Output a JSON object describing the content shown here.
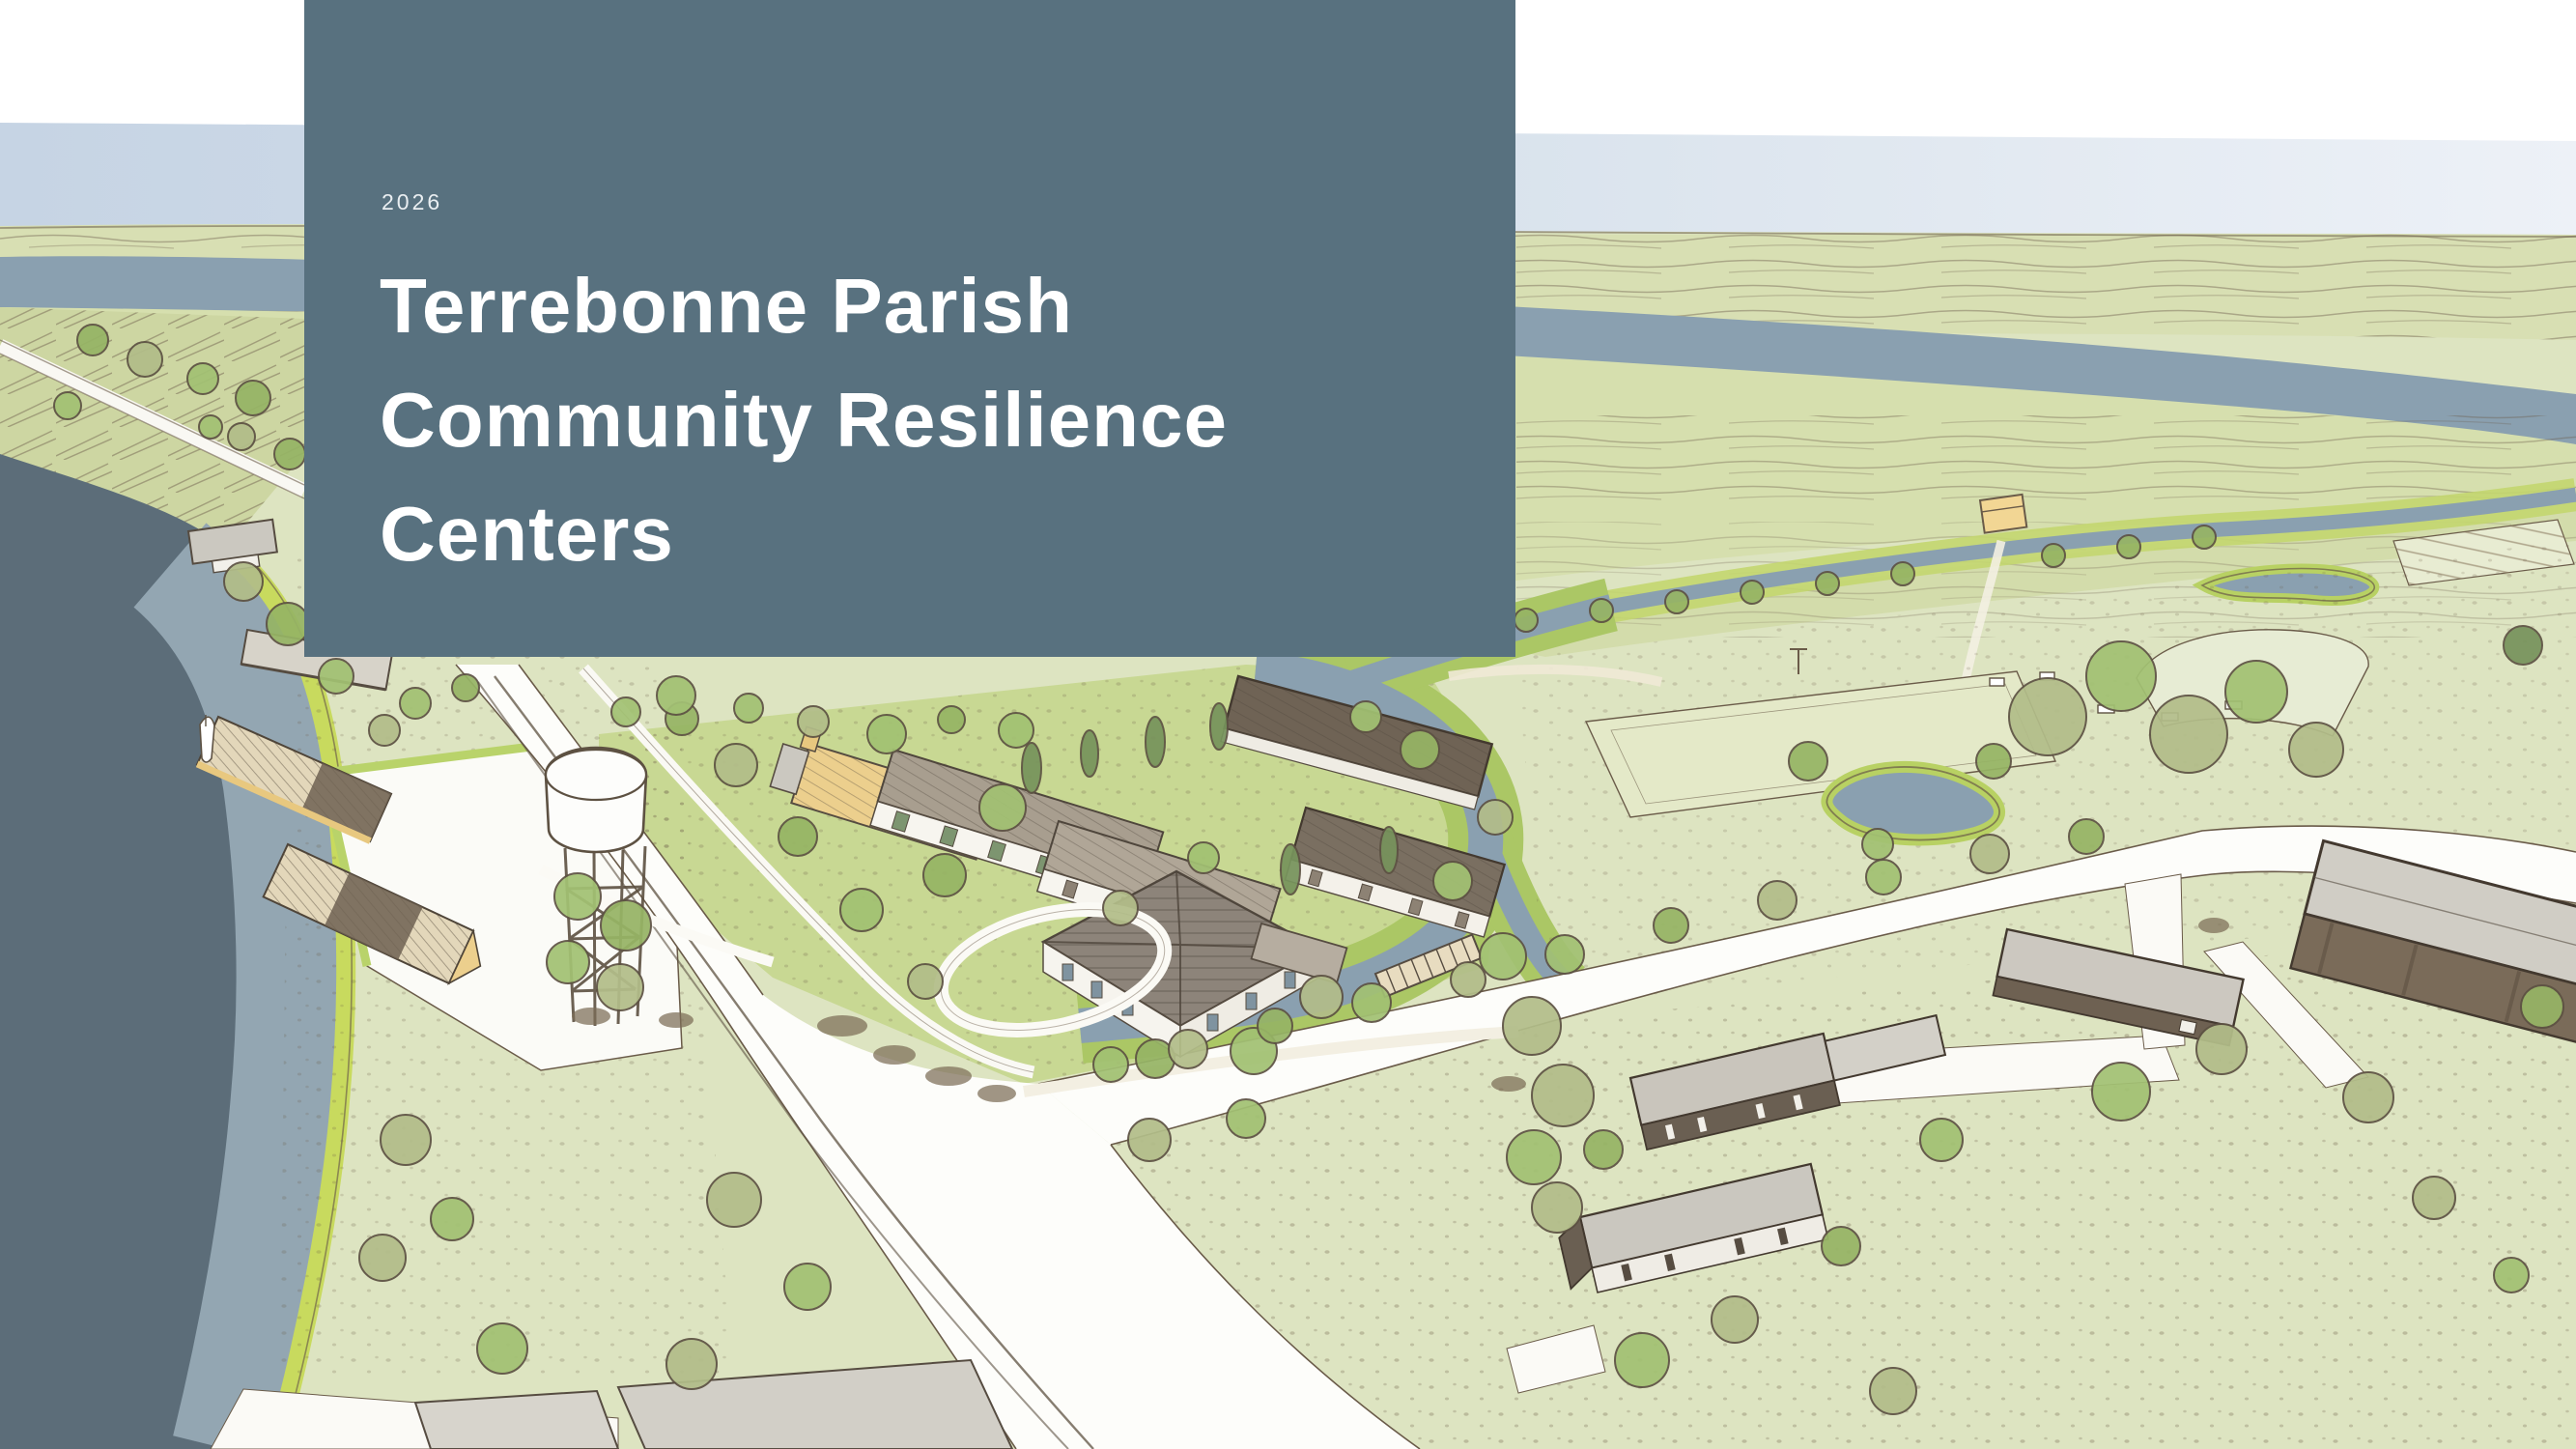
{
  "cover": {
    "year": "2026",
    "title_lines": [
      "Terrebonne Parish",
      "Community Resilience",
      "Centers"
    ],
    "panel_color": "#58717f",
    "title_color": "#ffffff",
    "year_color": "#e9eef1"
  },
  "illustration": {
    "scene": "Hand-drawn aerial sketch of a bayou-side community: white sky band, pale blue sky, marsh horizon, wide slate river, bay shoreline with pier buildings and sailboat, white water tower on trestle legs, campus of resilience-center buildings wrapped by a lagoon, diagonal main road with branch road, sports fields, ponds, farm houses and a large warehouse",
    "palette": {
      "sky": "#c6d4e4",
      "sky_right": "#edf1f7",
      "marsh": "#d8dfb3",
      "river": "#8aa0b0",
      "bay_deep": "#5c6d79",
      "bay_shallow": "#93a6b2",
      "shoreline": "#c8da5e",
      "land": "#dde4c1",
      "lawn_bright": "#c8d893",
      "road": "#fdfdfa",
      "ink": "#5d5142",
      "roof_gray": "#b0a697",
      "roof_dark": "#6f6355",
      "roof_yellow": "#eccf8d",
      "tree_olive": "#b2bd89",
      "tree_green": "#a2c173"
    }
  }
}
